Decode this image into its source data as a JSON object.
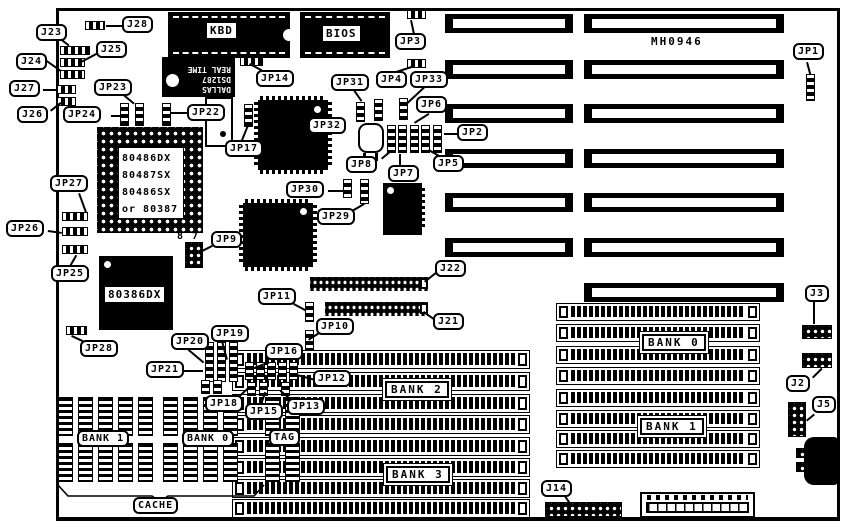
{
  "board": {
    "marking": "MH0946"
  },
  "chips": {
    "kbd": "KBD",
    "bios": "BIOS",
    "dallas": {
      "brand": "DALLAS",
      "part": "DS1287",
      "function": "REAL TIME"
    },
    "cpu_socket": {
      "lines": [
        "80486DX",
        "80487SX",
        "80486SX",
        "or 80387"
      ]
    },
    "cpu2": "80386DX"
  },
  "memory": {
    "bank0": "BANK 0",
    "bank1": "BANK 1",
    "bank2": "BANK 2",
    "bank3": "BANK 3"
  },
  "cache": {
    "bank1": "BANK 1",
    "bank0": "BANK 0",
    "tag": "TAG",
    "label": "CACHE"
  },
  "pin_markers": {
    "jp9_pin8": "8",
    "jp9_pin7": "7"
  },
  "labels": {
    "j2": "J2",
    "j3": "J3",
    "j5": "J5",
    "j14": "J14",
    "j21": "J21",
    "j22": "J22",
    "j23": "J23",
    "j24": "J24",
    "j25": "J25",
    "j26": "J26",
    "j27": "J27",
    "j28": "J28",
    "jp1": "JP1",
    "jp2": "JP2",
    "jp3": "JP3",
    "jp4": "JP4",
    "jp5": "JP5",
    "jp6": "JP6",
    "jp7": "JP7",
    "jp8": "JP8",
    "jp9": "JP9",
    "jp10": "JP10",
    "jp11": "JP11",
    "jp12": "JP12",
    "jp13": "JP13",
    "jp14": "JP14",
    "jp15": "JP15",
    "jp16": "JP16",
    "jp17": "JP17",
    "jp18": "JP18",
    "jp19": "JP19",
    "jp20": "JP20",
    "jp21": "JP21",
    "jp22": "JP22",
    "jp23": "JP23",
    "jp24": "JP24",
    "jp25": "JP25",
    "jp26": "JP26",
    "jp27": "JP27",
    "jp28": "JP28",
    "jp29": "JP29",
    "jp30": "JP30",
    "jp31": "JP31",
    "jp32": "JP32",
    "jp33": "JP33"
  }
}
